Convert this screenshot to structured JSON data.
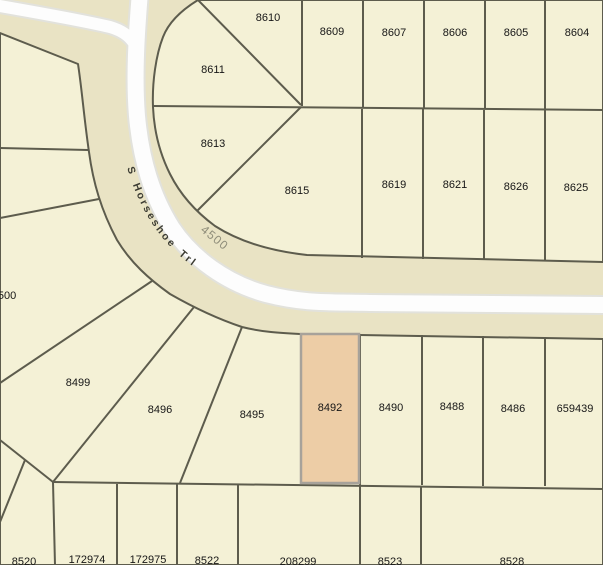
{
  "road": {
    "name": "S Horseshoe Trl",
    "number": "4500"
  },
  "highlight": {
    "parcel": "8492",
    "fill": "#edcda6",
    "border": "#a7a29a"
  },
  "colors": {
    "parcel_fill": "#f4f1d6",
    "road_corridor": "#e9e3c4",
    "road_pavement": "#fdfdfd",
    "boundary_line": "#5d5c4d",
    "parcel_label_text": "#161616",
    "road_name_text": "#3b3b32",
    "block_number_text": "#8f8d7a"
  },
  "parcels": {
    "8610": "8610",
    "8609": "8609",
    "8607": "8607",
    "8606": "8606",
    "8605": "8605",
    "8604": "8604",
    "8611": "8611",
    "8613": "8613",
    "8615": "8615",
    "8619": "8619",
    "8621": "8621",
    "8626": "8626",
    "8625": "8625",
    "500": "500",
    "8499": "8499",
    "8496": "8496",
    "8495": "8495",
    "8492": "8492",
    "8490": "8490",
    "8488": "8488",
    "8486": "8486",
    "659439": "659439",
    "8520": "8520",
    "172974": "172974",
    "172975": "172975",
    "8522": "8522",
    "208299": "208299",
    "8523": "8523",
    "8528": "8528"
  }
}
